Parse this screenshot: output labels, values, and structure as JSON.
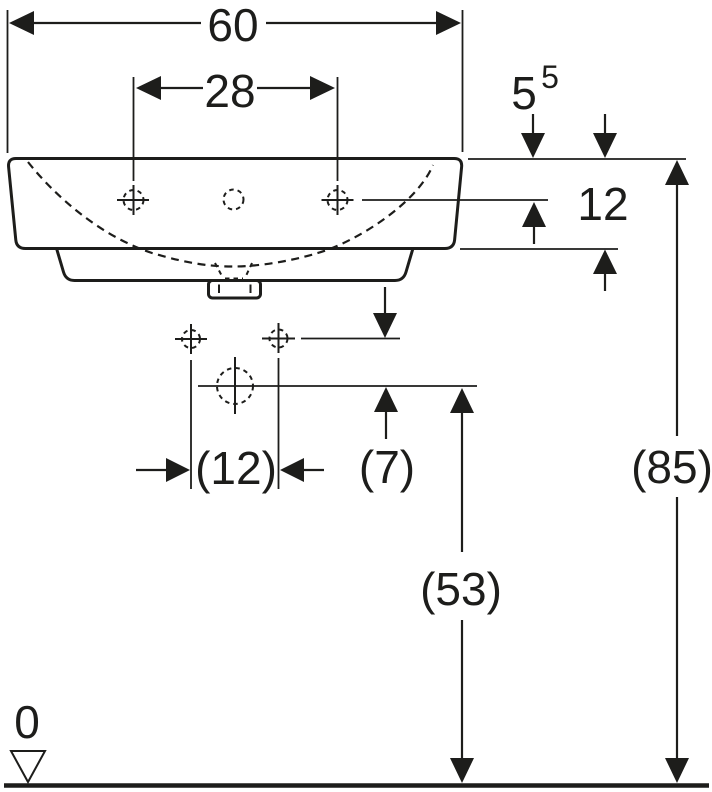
{
  "page": {
    "background_color": "#ffffff",
    "line_color": "#1d1d1b"
  },
  "drawing": {
    "dimensions": {
      "overall_width": {
        "value": "60"
      },
      "tap_hole_spacing": {
        "value": "28"
      },
      "rim_to_tap_hole": {
        "value": "5",
        "superscript": "5"
      },
      "rim_to_apron_bottom": {
        "value": "12"
      },
      "fixing_hole_spacing": {
        "value": "(12)"
      },
      "fixing_to_drain_offset": {
        "value": "(7)"
      },
      "floor_to_drain": {
        "value": "(53)"
      },
      "floor_to_rim": {
        "value": "(85)"
      },
      "floor_datum": {
        "value": "0"
      }
    }
  }
}
